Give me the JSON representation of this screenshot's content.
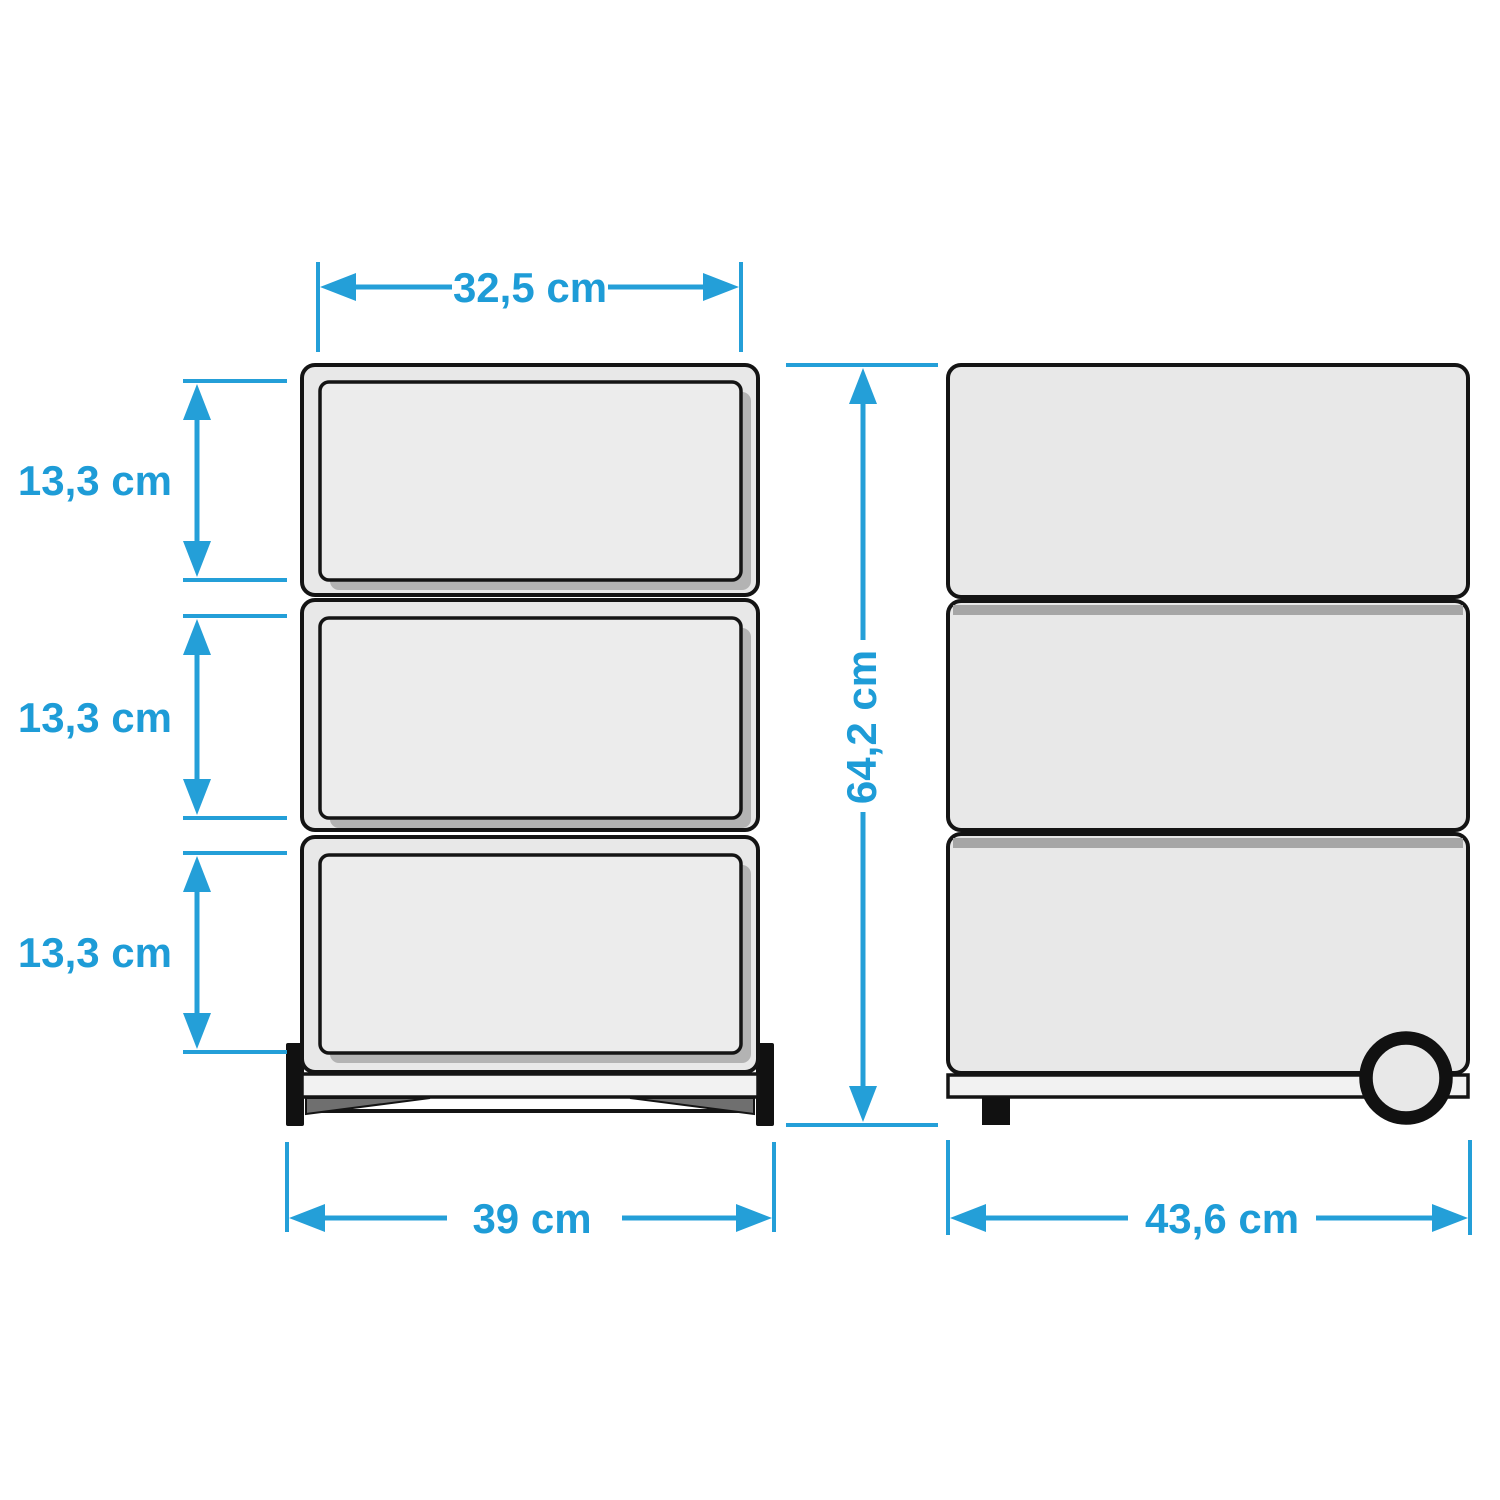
{
  "diagram": {
    "kind": "furniture-dimension-drawing",
    "subject": "mobile pedestal cabinet with 3 drawers and casters",
    "unit": "cm",
    "accent_color": "#249fd8",
    "line_color": "#141414",
    "body_fill": "#e8e8e8"
  },
  "front_view": {
    "name": "front elevation",
    "drawer_count": 3,
    "dims": {
      "drawer_width": {
        "label": "32,5 cm",
        "value_cm": 32.5
      },
      "drawer_heights": [
        {
          "label": "13,3 cm",
          "value_cm": 13.3
        },
        {
          "label": "13,3 cm",
          "value_cm": 13.3
        },
        {
          "label": "13,3 cm",
          "value_cm": 13.3
        }
      ],
      "overall_width": {
        "label": "39 cm",
        "value_cm": 39
      }
    }
  },
  "side_view": {
    "name": "side elevation",
    "dims": {
      "overall_height": {
        "label": "64,2 cm",
        "value_cm": 64.2
      },
      "overall_depth": {
        "label": "43,6 cm",
        "value_cm": 43.6
      }
    }
  }
}
